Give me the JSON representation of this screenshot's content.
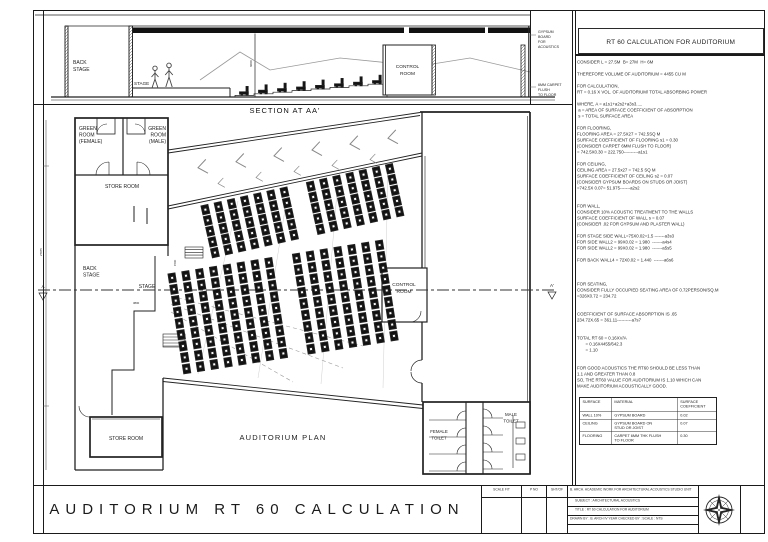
{
  "sheet": {
    "big_title": "AUDITORIUM RT 60 CALCULATION"
  },
  "section": {
    "label": "SECTION AT AA'",
    "back_stage": [
      "BACK",
      "STAGE"
    ],
    "stage": "STAGE",
    "control_room": [
      "CONTROL",
      "ROOM"
    ],
    "note_gypsum": [
      "GYPSUM",
      "BOARD",
      "FOR",
      "ACOUSTICS"
    ],
    "note_carpet": [
      "6MM CARPET",
      "FLUSH",
      "TO FLOOR"
    ],
    "dim": "6000",
    "seat_steps": 8
  },
  "plan": {
    "label": "AUDITORIUM PLAN",
    "green_female": [
      "GREEN",
      "ROOM",
      "(FEMALE)"
    ],
    "green_male": [
      "GREEN",
      "ROOM",
      "(MALE)"
    ],
    "store_room": "STORE ROOM",
    "store_room2": "STORE ROOM",
    "back_stage": [
      "BACK",
      "STAGE"
    ],
    "stage": "STAGE",
    "control_room": [
      "CONTROL",
      "ROOM"
    ],
    "female_toilet": [
      "FEMALE",
      "TOILET"
    ],
    "male_toilet": [
      "MALE",
      "TOILET"
    ],
    "marker_a": "A",
    "marker_a_prime": "A'",
    "dims": [
      "3800",
      "1500",
      "27975"
    ],
    "seating": {
      "upper": {
        "cols": 15,
        "rows": 5,
        "col_pitch": 13.5,
        "row_pitch": 11,
        "aisle_col": 7,
        "group": "seats-upper"
      },
      "lower": {
        "cols": 16,
        "rows": 9,
        "col_pitch": 14,
        "row_pitch": 11.5,
        "aisle_col": 8,
        "group": "seats-lower"
      }
    },
    "chevron_rows": [
      {
        "n": 6,
        "x0": 165,
        "y0": 61.7,
        "dx": 38,
        "dy": -5.9,
        "s": 1.0
      },
      {
        "n": 5,
        "x0": 185,
        "y0": 77.6,
        "dx": 38,
        "dy": -6.0,
        "s": 0.68
      }
    ]
  },
  "calc": {
    "title": "RT 60 CALCULATION FOR AUDITORIUM",
    "lines": [
      "CONSIDER L = 27.5M  B= 27M  H= 6M",
      "",
      "THEREFORE VOLUME OF AUDITORIUM = 4455 CU M",
      "",
      "FOR CALCULATION,",
      "RT = 0.16 X VOL. OF AUDITORIUM/ TOTAL ABSORBING POWER",
      "",
      "WHERE, A = a1s1+a2s2+a3s3.....",
      " a = AREA OF SURFACE COEFFICIENT OF ABSORPTION",
      " s = TOTAL SURFACE AREA",
      "",
      "FOR FLOORING,",
      "FLOORING AREA = 27.5X27 = 742.5SQ M",
      "SURFACE COEFFICIENT OF FLOORING s1 = 0.30",
      "(CONSIDER CARPET 6MM FLUSH TO FLOOR)",
      "= 742.5X0.30 = 222.750----------a1s1",
      "",
      "FOR CEILING,",
      "CEILING AREA = 27.5x27 = 742.5 SQ M",
      "SURFACE COEFFICIENT OF CEILING s2 = 0.07",
      "(CONSIDER GYPSUM BOARDS ON STUDS OR JOIST)",
      "=742.5X 0.07= 51.975-------a2s2",
      "",
      "",
      "FOR WALL,",
      "CONSIDER 10% ACOUSTIC TREATMENT TO THE WALLS",
      "SURFACE COEFFICIENT OF WALL s = 0.07",
      "(CONSIDER .02 FOR GYPSUM AND PLASTER WALL)",
      "",
      "FOR STAGE SIDE WALL=75X0.02=1.5 -------a3s3",
      "FOR SIDE WALL2 = 99X0.02 = 1.980  -------a4s4",
      "FOR SIDE WALL2 = 99X0.02 = 1.980  -------a5s5",
      "",
      "FOR BACK WALL4 = 72X0.02 = 1.440  -------a6s6",
      "",
      "",
      "",
      "FOR SEATING,",
      "CONSIDER FULLY OCCUPIED SEATING AREA OF 0.72PERSON/SQ.M",
      "=326X0.72 = 234.72",
      "",
      "",
      "COEFFICIENT OF SURFACE ABSORPTION IS .65",
      "234.72X.65 = 361.11----------a7s7",
      "",
      "",
      "TOTAL RT 60 = 0.16XV/A",
      "       = 0.16X4455/642.3",
      "       = 1.10",
      "",
      "",
      "FOR GOOD ACOUSTICS THE RT60 SHOULD BE LESS THAN",
      "1.1 AND GREATER THAN 0.8",
      "SO, THE RT60 VALUE FOR AUDITORIUM IS 1.10 WHICH CAN",
      "MAKE AUDITORIUM ACOUSTICALLY GOOD."
    ],
    "table": {
      "headers": [
        "SURFACE",
        "MATERIAL",
        "SURFACE\nCOEFFICIENT"
      ],
      "rows": [
        [
          "WALL 10%",
          "GYPSUM BOARD",
          "0.02"
        ],
        [
          "CEILING",
          "GYPSUM BOARD ON\nSTUD OR JOIST",
          "0.07"
        ],
        [
          "FLOORING",
          "CARPET 6MM THK FLUSH\nTO FLOOR",
          "0.30"
        ]
      ]
    }
  },
  "titleblock": {
    "cells": [
      "SCALE FIT",
      "P NO",
      "SHT/OF"
    ],
    "info": [
      "B. ARCH. ACADEMIC WORK FOR ARCHITECTURAL ACOUSTICS STUDIO UNIT",
      "SUBJECT : ARCHITECTURAL ACOUSTICS",
      "TITLE : RT 60 CALCULATION  FOR AUDITORIUM",
      "DRAWN BY : B. ARCH IV YEAR      CHECKED BY :        SCALE : NTS"
    ]
  }
}
